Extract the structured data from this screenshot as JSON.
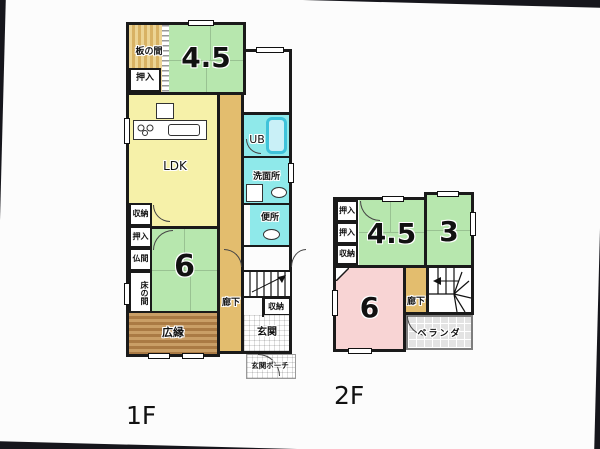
{
  "colors": {
    "wall": "#1a1a1a",
    "tatami-green": "#b7e7ae",
    "ldk-yellow": "#f6f1a9",
    "corridor-tan": "#e3bd6e",
    "wet-cyan": "#8fe9ea",
    "room-pink": "#f8d4d4",
    "veranda-gray": "#e3e3e3",
    "photo-bg": "#16161c"
  },
  "floor1": {
    "label": "1F",
    "rooms": {
      "itanoma": "板の間",
      "oshiire_top": "押入",
      "tatami_45": "4.5",
      "ldk": "LDK",
      "ub": "UB",
      "senmenjo": "洗面所",
      "benjo": "便所",
      "shuno_left": "収納",
      "oshiire_left": "押入",
      "butsuma": "仏間",
      "tokonoma": "床の間",
      "tatami_6": "6",
      "hiroen": "広縁",
      "roka": "廊下",
      "shuno_right": "収納",
      "genkan": "玄関",
      "porch": "玄関ポーチ"
    }
  },
  "floor2": {
    "label": "2F",
    "rooms": {
      "oshiire_1": "押入",
      "oshiire_2": "押入",
      "shuno": "収納",
      "tatami_45": "4.5",
      "tatami_3": "3",
      "tatami_6": "6",
      "roka": "廊下",
      "veranda": "ベランダ"
    }
  }
}
